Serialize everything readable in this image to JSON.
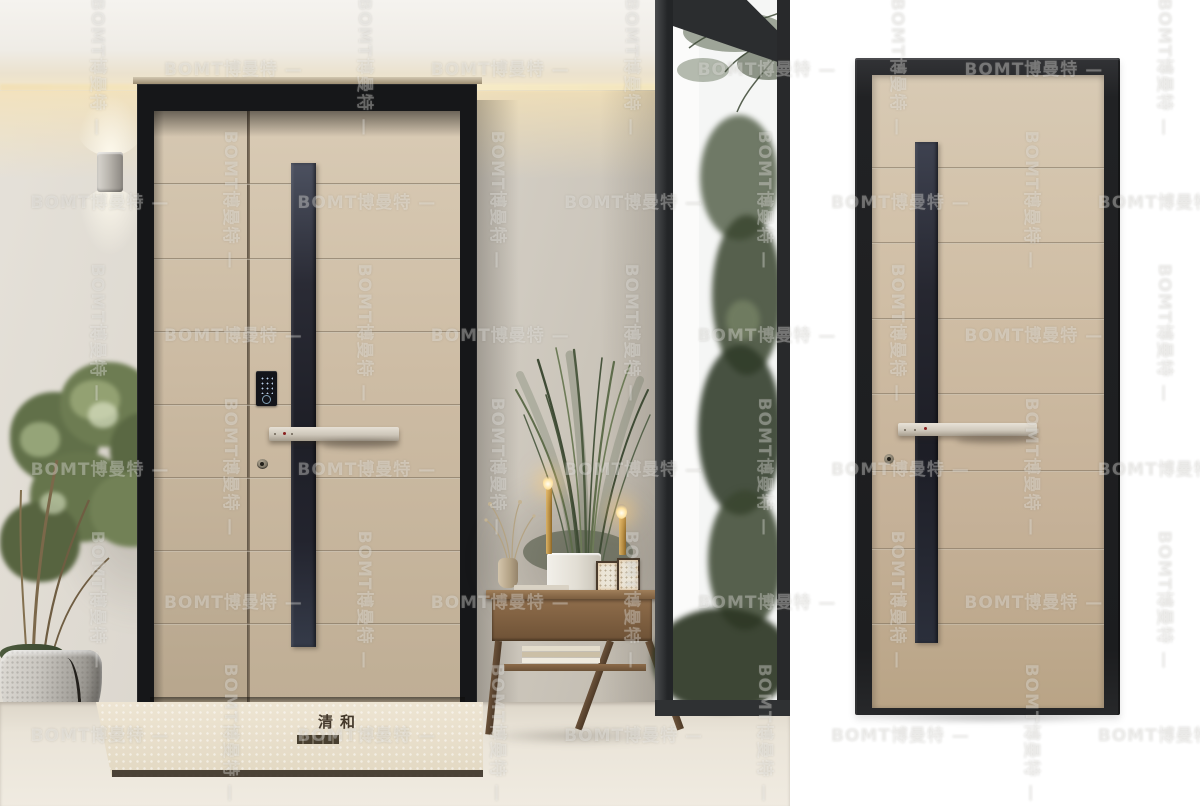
{
  "watermark": {
    "brand_en": "BOMT",
    "brand_cn": "博曼特",
    "full": "BOMT博曼特",
    "dash": "—"
  },
  "doormat": {
    "brand": "清和"
  },
  "palette": {
    "door_panel_tan": "#cbb89f",
    "stripe_charcoal": "#23242c",
    "frame_black": "#1d1e20",
    "wall_greige": "#d8d3ca",
    "cove_glow": "#f6e8c6",
    "foliage_green": "#5d6b45",
    "floor_cream": "#ece7dd",
    "sky_white": "#f5f6f5",
    "wood_walnut": "#8a6a49",
    "candle_gold": "#c19a52",
    "mat_cream": "#e9e0cd",
    "mat_trim_brown": "#3a3127",
    "background_white": "#ffffff"
  }
}
